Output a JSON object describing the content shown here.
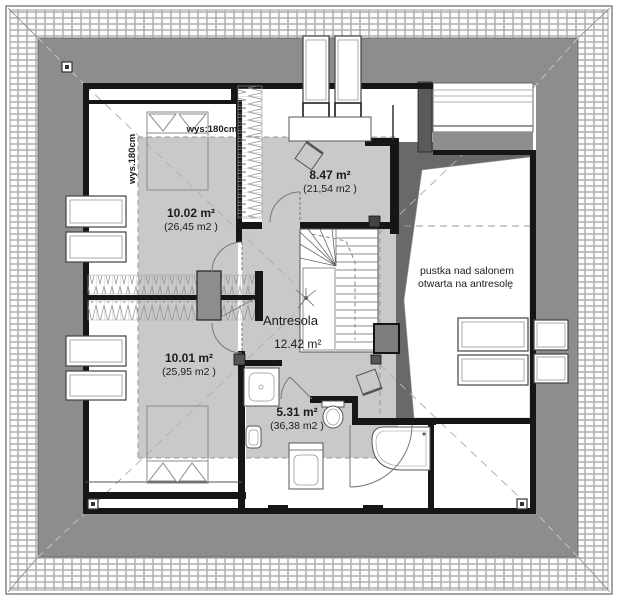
{
  "rooms": {
    "bedroom_top": {
      "area": "10.02 m²",
      "total": "(26,45 m2 )"
    },
    "study": {
      "area": "8.47 m²",
      "total": "(21,54 m2 )"
    },
    "bedroom_bottom": {
      "area": "10.01 m²",
      "total": "(25,95 m2 )"
    },
    "bathroom": {
      "area": "5.31 m²",
      "total": "(36,38 m2 )"
    },
    "mezzanine": {
      "name": "Antresola",
      "area": "12.42 m²"
    }
  },
  "annotations": {
    "void_line1": "pustka nad salonem",
    "void_line2": "otwarta na antresolę",
    "height_horizontal": "wys:180cm",
    "height_vertical": "wys.180cm"
  },
  "colors": {
    "roof_band": "#8d8d8d",
    "roof_slope_dark": "#696969",
    "usable_area": "#c9c9c9",
    "wall": "#161616",
    "floor": "#ffffff",
    "furniture_line": "#6f6f6f"
  }
}
